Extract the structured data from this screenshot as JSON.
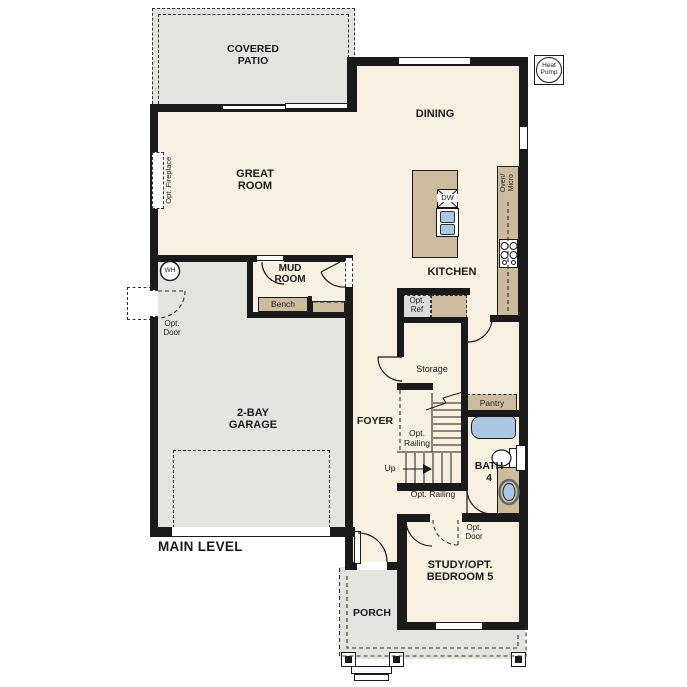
{
  "plan": {
    "title": "MAIN LEVEL",
    "rooms": {
      "covered_patio": "COVERED PATIO",
      "great_room": "GREAT ROOM",
      "dining": "DINING",
      "kitchen": "KITCHEN",
      "mud_room": "MUD ROOM",
      "garage": "2-BAY GARAGE",
      "foyer": "FOYER",
      "storage": "Storage",
      "pantry": "Pantry",
      "bath": "BATH 4",
      "study": "STUDY/OPT. BEDROOM 5",
      "porch": "PORCH"
    },
    "annotations": {
      "heat_pump": "Heat Pump",
      "water_heater": "WH",
      "opt_fireplace": "Opt. Fireplace",
      "opt_door_garage": "Opt. Door",
      "opt_door_study": "Opt. Door",
      "opt_ref": "Opt. Ref",
      "opt_railing_upper": "Opt. Railing",
      "opt_railing_lower": "Opt. Railing",
      "bench": "Bench",
      "dishwasher": "DW",
      "oven_micro": "Oven/ Micro",
      "up": "Up"
    },
    "colors": {
      "wall": "#1a1a1a",
      "interior": "#f8f0e1",
      "exterior_concrete": "#e3e3e0",
      "cabinetry": "#cbbc9e",
      "fixture_blue": "#aac8e6",
      "background": "#ffffff"
    }
  }
}
